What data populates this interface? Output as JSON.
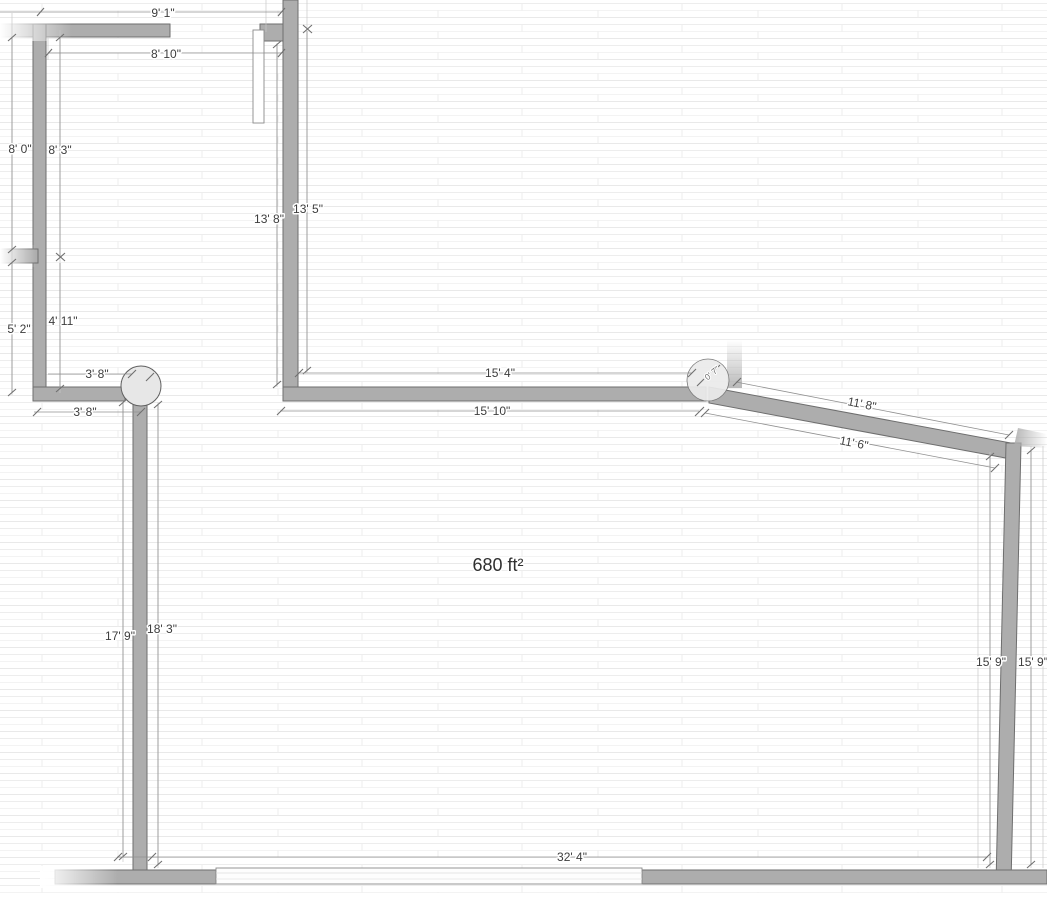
{
  "view": {
    "type": "floor-plan-canvas",
    "area_label": "680 ft²"
  },
  "dimensions": {
    "top_outer": "9' 1\"",
    "top_inner": "8' 10\"",
    "left_upper_outer": "8' 0\"",
    "left_upper_inner": "8' 3\"",
    "room1_right_inner": "13' 8\"",
    "room1_right_outer": "13' 5\"",
    "left_lower_outer": "5' 2\"",
    "left_lower_inner": "4' 11\"",
    "passage_upper": "3' 8\"",
    "passage_lower": "3' 8\"",
    "mid_inner": "15' 4\"",
    "mid_outer": "15' 10\"",
    "column_offset": "0' 7\"",
    "diagonal_upper": "11' 8\"",
    "diagonal_lower": "11' 6\"",
    "right_inner": "15' 9\"",
    "right_outer": "15' 9\"",
    "interior_left": "17' 9\"",
    "interior_right": "18' 3\"",
    "bottom": "32' 4\""
  },
  "colors": {
    "wall_fill": "#adadad",
    "wall_edge": "#6e6e6e",
    "dimension_line": "#909090",
    "dimension_text": "#3d3d3d",
    "floor_stripe": "#ececec",
    "column_fill": "#e8e8e8"
  }
}
